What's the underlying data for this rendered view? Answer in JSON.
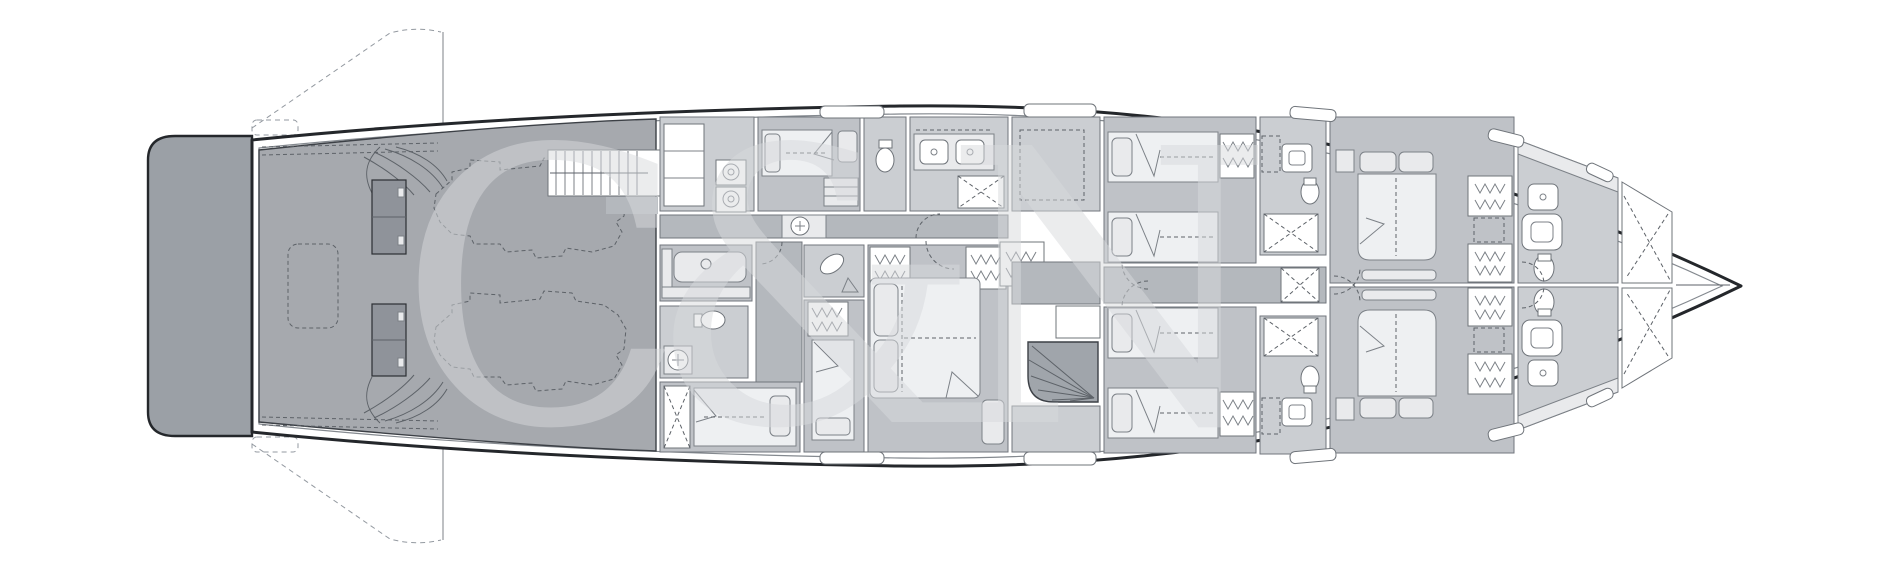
{
  "page": {
    "background": "#ffffff",
    "kind": "yacht-lower-deck-floor-plan"
  },
  "watermark": {
    "text": "C&N"
  },
  "colors": {
    "hull_outline": "#24272b",
    "hull_inner_line": "#84898f",
    "swim_platform": "#9ba0a6",
    "engine_room": "#a6a9ae",
    "floor_cabin": "#bfc2c7",
    "floor_bath": "#cbced2",
    "floor_corridor": "#b4b8bd",
    "furniture": "#e9eaec",
    "stairs": "#a0a5ab",
    "detail_line": "#5d6268",
    "watermark": "#d8dadd"
  },
  "zones": [
    {
      "id": "swim-platform"
    },
    {
      "id": "engine-room"
    },
    {
      "id": "crew-laundry"
    },
    {
      "id": "crew-cabin-aft"
    },
    {
      "id": "crew-bathrooms"
    },
    {
      "id": "crew-mess"
    },
    {
      "id": "crew-bunk-cabin"
    },
    {
      "id": "captain-cabin"
    },
    {
      "id": "guest-lobby-stairs"
    },
    {
      "id": "twin-cabin-port"
    },
    {
      "id": "twin-cabin-starboard"
    },
    {
      "id": "guest-bathrooms"
    },
    {
      "id": "lift"
    },
    {
      "id": "vip-cabin-port"
    },
    {
      "id": "vip-cabin-starboard"
    },
    {
      "id": "vip-bathrooms"
    },
    {
      "id": "forepeak"
    }
  ],
  "fixtures": {
    "engines": 2,
    "double_beds": 3,
    "single_beds": 7,
    "toilets": 7,
    "showers": 7,
    "washer_dryer_stacks": 1,
    "staircases": 3
  }
}
